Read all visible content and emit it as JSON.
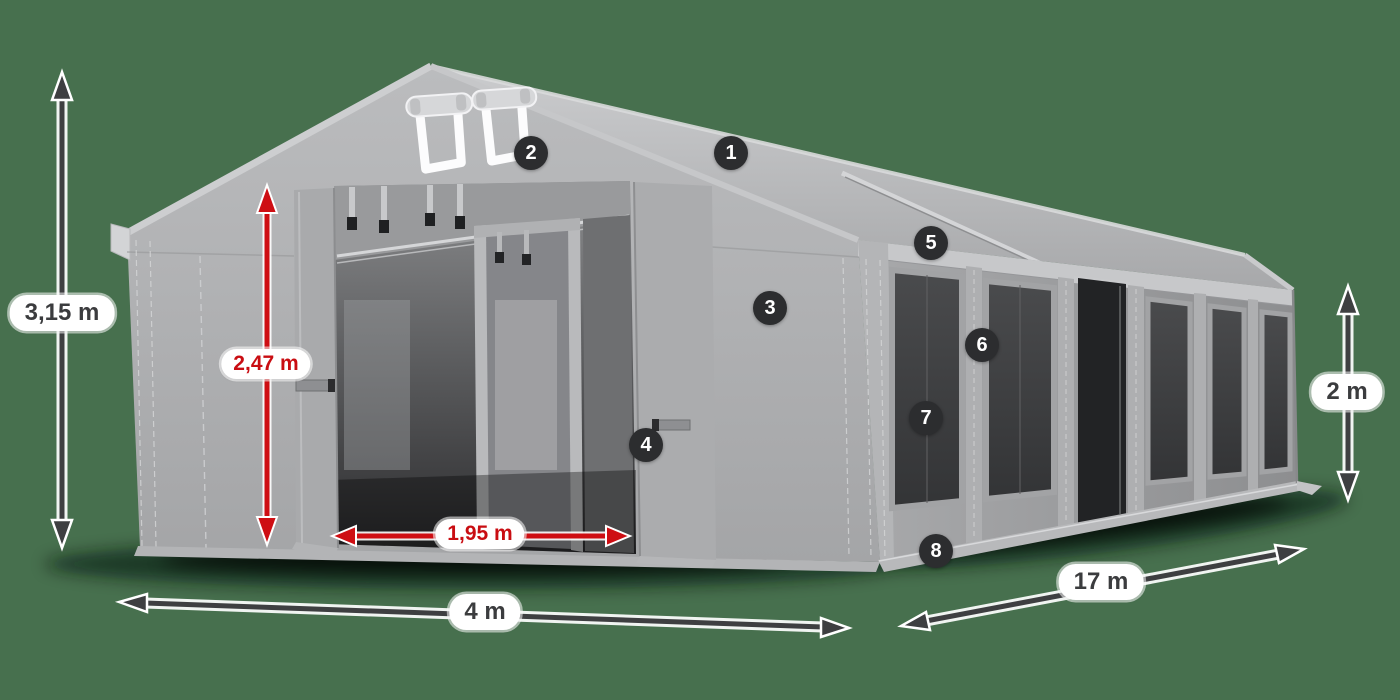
{
  "scene": {
    "type": "product-dimension-diagram",
    "subject": "marquee storage tent",
    "background_color": "#47704e"
  },
  "colors": {
    "background": "#47704e",
    "dimension_red": "#c90d12",
    "dimension_dark": "#3b3c3e",
    "arrow_dark": "#3e3f41",
    "badge_background": "#2c2d2f",
    "badge_text": "#ffffff",
    "label_pill_background": "#ffffff",
    "tent_fabric_light": "#c6c7c9",
    "tent_fabric_mid": "#aaabad",
    "tent_fabric_dark": "#8f9092"
  },
  "dimensions": {
    "total_height": {
      "label": "3,15 m",
      "style": "dark"
    },
    "door_height": {
      "label": "2,47 m",
      "style": "red"
    },
    "door_width": {
      "label": "1,95 m",
      "style": "red"
    },
    "front_width": {
      "label": "4 m",
      "style": "dark"
    },
    "side_length": {
      "label": "17 m",
      "style": "dark"
    },
    "side_height": {
      "label": "2 m",
      "style": "dark"
    }
  },
  "callouts": [
    {
      "label": "1"
    },
    {
      "label": "2"
    },
    {
      "label": "3"
    },
    {
      "label": "4"
    },
    {
      "label": "5"
    },
    {
      "label": "6"
    },
    {
      "label": "7"
    },
    {
      "label": "8"
    }
  ]
}
